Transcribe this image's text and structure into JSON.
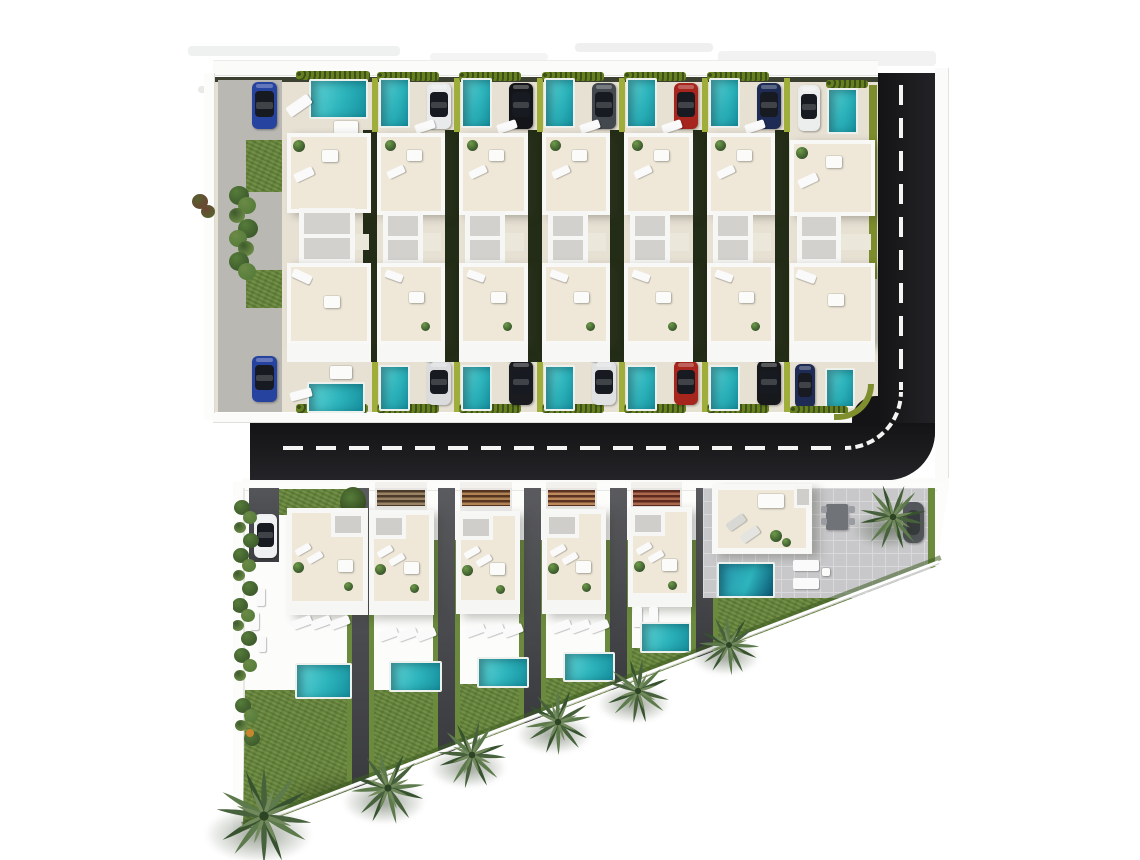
{
  "scene": {
    "canvas": {
      "w": 1140,
      "h": 860,
      "bg": "#ffffff"
    },
    "palette": {
      "sidewalk": "#fbfbfa",
      "sidewalk_line": "#e0e0dc",
      "ground_beige": "#e7e1d4",
      "lane_gray": "#bab8b3",
      "building_white": "#f7f7f5",
      "terrace_beige": "#efe8d9",
      "atrium_gray": "#d2d1cd",
      "bridge_beige": "#ece7db",
      "gap_dark": "#232c16",
      "road": "#161618",
      "road_line": "#f4f4f2",
      "divider_green": "#9fae3a",
      "lawn": "#6b8a3e",
      "pool_light": "#66d8d8",
      "pool_dark": "#16919f",
      "pool_deep_a": "#2a93ab",
      "pool_deep_b": "#0b5674",
      "band_a": "#5a5b5f",
      "band_b": "#3a3b3f",
      "pavers": "#c8c8ca",
      "furniture_white": "#fafafa",
      "palm_green": "#46613b",
      "shrub_green": "#3d5a2c"
    },
    "top_strips": [
      {
        "x": 188,
        "y": 46,
        "w": 212,
        "h": 10,
        "c": "#eff0f0"
      },
      {
        "x": 430,
        "y": 53,
        "w": 118,
        "h": 8,
        "c": "#f3f4f3"
      },
      {
        "x": 575,
        "y": 43,
        "w": 138,
        "h": 9,
        "c": "#eeefee"
      },
      {
        "x": 718,
        "y": 51,
        "w": 218,
        "h": 15,
        "c": "#f1f2f1"
      },
      {
        "x": 198,
        "y": 86,
        "w": 46,
        "h": 7,
        "c": "#e9e9e6"
      }
    ],
    "upper_block": {
      "x": 215,
      "w": 663,
      "ground_y": 80,
      "ground_h": 332,
      "strips": [
        {
          "name": "upper-villa-1",
          "x": 215,
          "w": 160,
          "kind": "end-left",
          "car_top": "#2743a0",
          "car_bottom": "#2743a0"
        },
        {
          "name": "upper-villa-2",
          "x": 375,
          "w": 82,
          "kind": "mid",
          "car_top": "#e9eaec",
          "car_bottom": "#d9dbdd"
        },
        {
          "name": "upper-villa-3",
          "x": 457,
          "w": 83,
          "kind": "mid",
          "car_top": "#141518",
          "car_bottom": "#1a1b1e"
        },
        {
          "name": "upper-villa-4",
          "x": 540,
          "w": 82,
          "kind": "mid",
          "car_top": "#43474e",
          "car_bottom": "#dfe1e3"
        },
        {
          "name": "upper-villa-5",
          "x": 622,
          "w": 83,
          "kind": "mid",
          "car_top": "#a6251c",
          "car_bottom": "#a6251c"
        },
        {
          "name": "upper-villa-6",
          "x": 705,
          "w": 82,
          "kind": "mid",
          "car_top": "#1d2b55",
          "car_bottom": "#17181b"
        },
        {
          "name": "upper-villa-7",
          "x": 787,
          "w": 91,
          "kind": "end-right",
          "car_top": "#eceded",
          "car_bottom": "#1d2b55"
        }
      ]
    },
    "roads": {
      "vertical": {
        "x": 878,
        "y": 73,
        "w": 57,
        "h": 407
      },
      "horizontal": {
        "x": 250,
        "y": 423,
        "w": 685,
        "h": 57
      },
      "corner_radius": 48,
      "dash_h": {
        "x": 283,
        "y": 446,
        "len": 560
      },
      "dash_v": {
        "x": 899,
        "y": 85,
        "len": 305
      },
      "curve": {
        "cx": 845,
        "cy": 392,
        "r": 56
      }
    },
    "lower_block": {
      "origin": {
        "x": 233,
        "y": 482,
        "w": 716,
        "h": 360
      },
      "clip": [
        [
          0,
          0
        ],
        [
          716,
          0
        ],
        [
          704,
          84
        ],
        [
          10,
          349
        ],
        [
          0,
          349
        ]
      ],
      "lawn_poly": [
        [
          12,
          208
        ],
        [
          222,
          208
        ],
        [
          222,
          202
        ],
        [
          312,
          202
        ],
        [
          312,
          196
        ],
        [
          399,
          196
        ],
        [
          399,
          166
        ],
        [
          470,
          166
        ],
        [
          470,
          116
        ],
        [
          704,
          84
        ],
        [
          10,
          349
        ]
      ],
      "bands": [
        {
          "x": 352,
          "h": 300
        },
        {
          "x": 438,
          "h": 267
        },
        {
          "x": 524,
          "h": 235
        },
        {
          "x": 610,
          "h": 202
        },
        {
          "x": 696,
          "h": 169
        }
      ],
      "villas": [
        {
          "name": "lower-villa-1",
          "building": {
            "x": 287,
            "y": 508,
            "w": 81,
            "h": 107
          },
          "panel_side": "right",
          "pool": {
            "x": 295,
            "y": 663,
            "w": 57,
            "h": 36
          },
          "car": {
            "x": 254,
            "y": 514,
            "w": 23,
            "h": 44,
            "color": "#eef0f2"
          },
          "driveway": {
            "x": 249,
            "y": 488,
            "w": 30,
            "h": 74
          },
          "lawn_patch": {
            "x": 262,
            "y": 489,
            "w": 88,
            "h": 26
          },
          "loungers": {
            "x": 292,
            "y": 618,
            "n": 3
          }
        },
        {
          "name": "lower-villa-2",
          "pergola": {
            "x": 375,
            "w": 52,
            "dark": "#4c3a2b",
            "light": "#9b8466"
          },
          "building": {
            "x": 369,
            "y": 510,
            "w": 65,
            "h": 105
          },
          "panel_side": "left",
          "pool": {
            "x": 389,
            "y": 661,
            "w": 53,
            "h": 31
          },
          "loungers": {
            "x": 378,
            "y": 630,
            "n": 3
          }
        },
        {
          "name": "lower-villa-3",
          "pergola": {
            "x": 460,
            "w": 52,
            "dark": "#55351f",
            "light": "#b08354"
          },
          "building": {
            "x": 456,
            "y": 511,
            "w": 64,
            "h": 103
          },
          "panel_side": "left",
          "pool": {
            "x": 477,
            "y": 657,
            "w": 52,
            "h": 31
          },
          "loungers": {
            "x": 465,
            "y": 626,
            "n": 3
          }
        },
        {
          "name": "lower-villa-4",
          "pergola": {
            "x": 546,
            "w": 51,
            "dark": "#5c3322",
            "light": "#bd8a5c"
          },
          "building": {
            "x": 542,
            "y": 509,
            "w": 64,
            "h": 105
          },
          "panel_side": "left",
          "pool": {
            "x": 563,
            "y": 652,
            "w": 52,
            "h": 30
          },
          "loungers": {
            "x": 551,
            "y": 622,
            "n": 3
          }
        },
        {
          "name": "lower-villa-5",
          "pergola": {
            "x": 631,
            "w": 51,
            "dark": "#5e2a20",
            "light": "#ab6a4e"
          },
          "building": {
            "x": 628,
            "y": 507,
            "w": 64,
            "h": 100
          },
          "panel_side": "left",
          "pool": {
            "x": 640,
            "y": 622,
            "w": 51,
            "h": 31
          },
          "loungers": {
            "x": 633,
            "y": 607,
            "n": 2,
            "vertical": true
          }
        }
      ],
      "corner_villa": {
        "name": "corner-villa",
        "patio": {
          "x": 703,
          "y": 488,
          "w": 232,
          "h": 110
        },
        "building": {
          "x": 712,
          "y": 484,
          "w": 100,
          "h": 70
        },
        "pool": {
          "x": 717,
          "y": 562,
          "w": 58,
          "h": 36
        },
        "loungers": [
          [
            793,
            560
          ],
          [
            793,
            578
          ]
        ],
        "table": {
          "x": 826,
          "y": 504,
          "w": 22,
          "h": 26
        },
        "car_object": {
          "x": 903,
          "y": 502,
          "w": 21,
          "h": 41
        },
        "green_edge": {
          "x": 928,
          "y": 488,
          "w": 7,
          "h": 80
        }
      }
    },
    "boundary": {
      "x1": 240,
      "y1": 829,
      "x2": 939,
      "y2": 562
    },
    "palms": [
      [
        264,
        816,
        104
      ],
      [
        388,
        788,
        80
      ],
      [
        472,
        755,
        74
      ],
      [
        558,
        722,
        72
      ],
      [
        638,
        691,
        70
      ],
      [
        729,
        645,
        66
      ],
      [
        893,
        517,
        72
      ]
    ],
    "shrub_clusters": [
      {
        "x": 231,
        "y": 186,
        "n": 8,
        "big": true
      },
      {
        "x": 194,
        "y": 194,
        "n": 2,
        "warm": true
      },
      {
        "x": 236,
        "y": 500,
        "n": 4
      },
      {
        "x": 235,
        "y": 548,
        "n": 4
      },
      {
        "x": 234,
        "y": 598,
        "n": 4
      },
      {
        "x": 236,
        "y": 648,
        "n": 3
      },
      {
        "x": 237,
        "y": 698,
        "n": 4
      }
    ],
    "accent_dot": {
      "x": 246,
      "y": 729,
      "c": "#c8862f"
    },
    "summary": {
      "upper_villa_strips": 7,
      "lower_villas": 6,
      "pools": 20,
      "parked_cars": 16,
      "palm_trees": 7
    }
  }
}
